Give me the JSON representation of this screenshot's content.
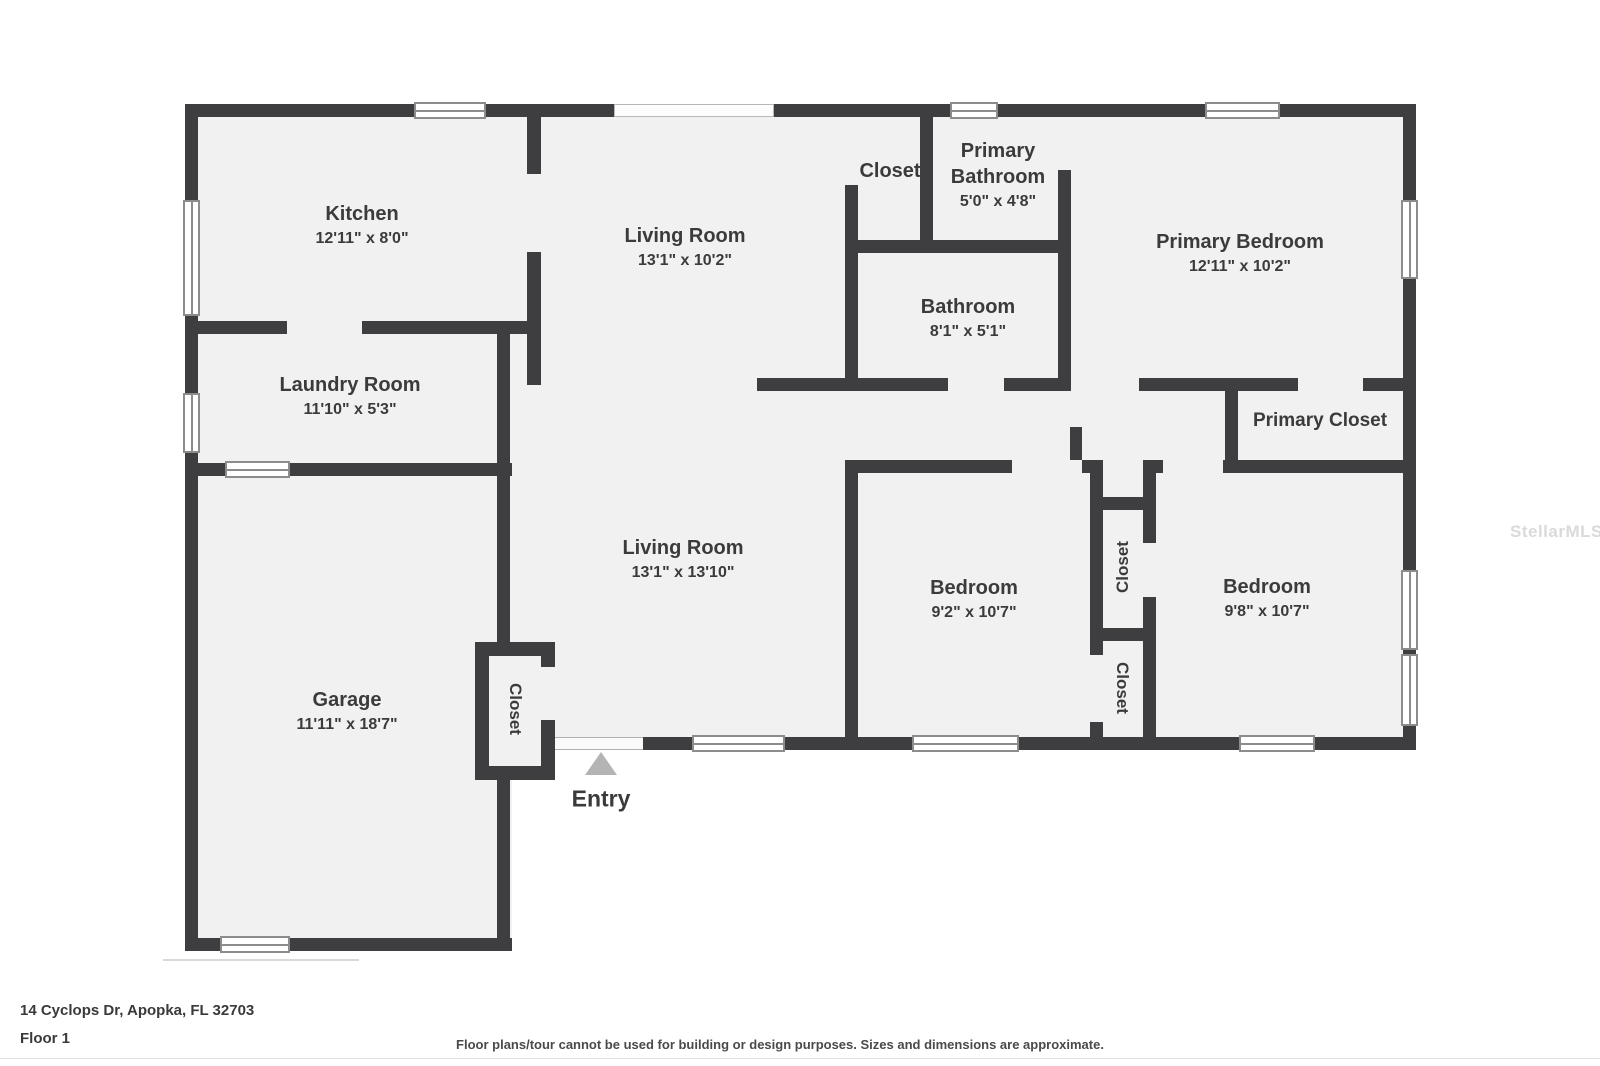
{
  "plan": {
    "rooms": [
      {
        "name": "Kitchen",
        "dims": "12'11\" x 8'0\""
      },
      {
        "name": "Living Room",
        "dims": "13'1\" x 10'2\""
      },
      {
        "name": "Closet",
        "dims": ""
      },
      {
        "name": "Primary Bathroom",
        "dims": "5'0\" x 4'8\""
      },
      {
        "name": "Primary Bedroom",
        "dims": "12'11\" x 10'2\""
      },
      {
        "name": "Bathroom",
        "dims": "8'1\" x 5'1\""
      },
      {
        "name": "Laundry Room",
        "dims": "11'10\" x 5'3\""
      },
      {
        "name": "Primary Closet",
        "dims": ""
      },
      {
        "name": "Living Room",
        "dims": "13'1\" x 13'10\""
      },
      {
        "name": "Bedroom",
        "dims": "9'2\" x 10'7\""
      },
      {
        "name": "Bedroom",
        "dims": "9'8\" x 10'7\""
      },
      {
        "name": "Garage",
        "dims": "11'11\" x 18'7\""
      },
      {
        "name": "Closet",
        "dims": ""
      },
      {
        "name": "Closet",
        "dims": ""
      },
      {
        "name": "Closet",
        "dims": ""
      }
    ],
    "entry_label": "Entry",
    "colors": {
      "wall": "#3e3e40",
      "floor": "#f1f1f2",
      "entry_arrow": "#b4b4b4"
    }
  },
  "footer": {
    "address": "14 Cyclops Dr, Apopka, FL 32703",
    "floor": "Floor 1",
    "disclaimer": "Floor plans/tour cannot be used for building or design purposes. Sizes and dimensions are approximate."
  },
  "watermark": "StellarMLS"
}
